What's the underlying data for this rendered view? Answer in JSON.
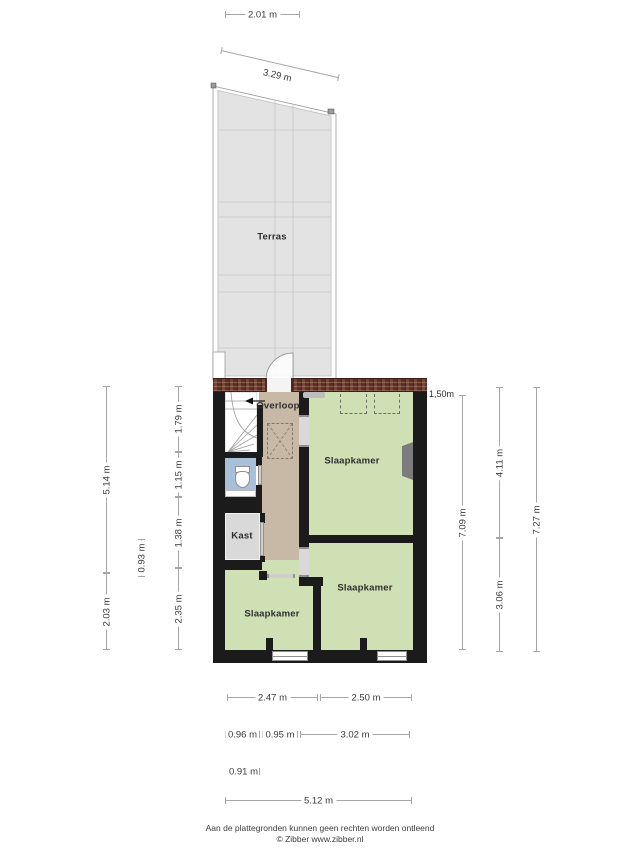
{
  "rooms": {
    "terrace": "Terras",
    "landing": "Overloop",
    "bedroom_top": "Slaapkamer",
    "bedroom_bottom_right": "Slaapkamer",
    "bedroom_bottom_left": "Slaapkamer",
    "closet": "Kast",
    "height_marker": "1,50m"
  },
  "dimensions": {
    "top_width": "2.01 m",
    "top_slope": "3.29 m",
    "left_total_upper": "5.14 m",
    "left_total_lower": "2.03 m",
    "left_mid": "0.93 m",
    "left_seg1": "1.79 m",
    "left_seg2": "1.15 m",
    "left_seg3": "1.38 m",
    "left_seg4": "2.35 m",
    "right_inner": "7.09 m",
    "right_seg1": "4.11 m",
    "right_seg2": "3.06 m",
    "right_total": "7.27 m",
    "bottom_room1": "2.47 m",
    "bottom_room2": "2.50 m",
    "bottom_seg1": "0.96 m",
    "bottom_seg2": "0.95 m",
    "bottom_seg3": "3.02 m",
    "bottom_seg4": "0.91 m",
    "bottom_total": "5.12 m"
  },
  "footer": {
    "line1": "Aan de plattegronden kunnen geen rechten worden ontleend",
    "line2": "© Zibber www.zibber.nl"
  },
  "colors": {
    "bedroom_fill": "#cfe0b5",
    "hall_fill": "#c8b9a6",
    "closet_fill": "#d9d9d9",
    "toilet_fill": "#a9c0da",
    "terrace_fill": "#e3e3e3",
    "wall": "#1b1b1b",
    "brick_wall": "#693a2b"
  }
}
